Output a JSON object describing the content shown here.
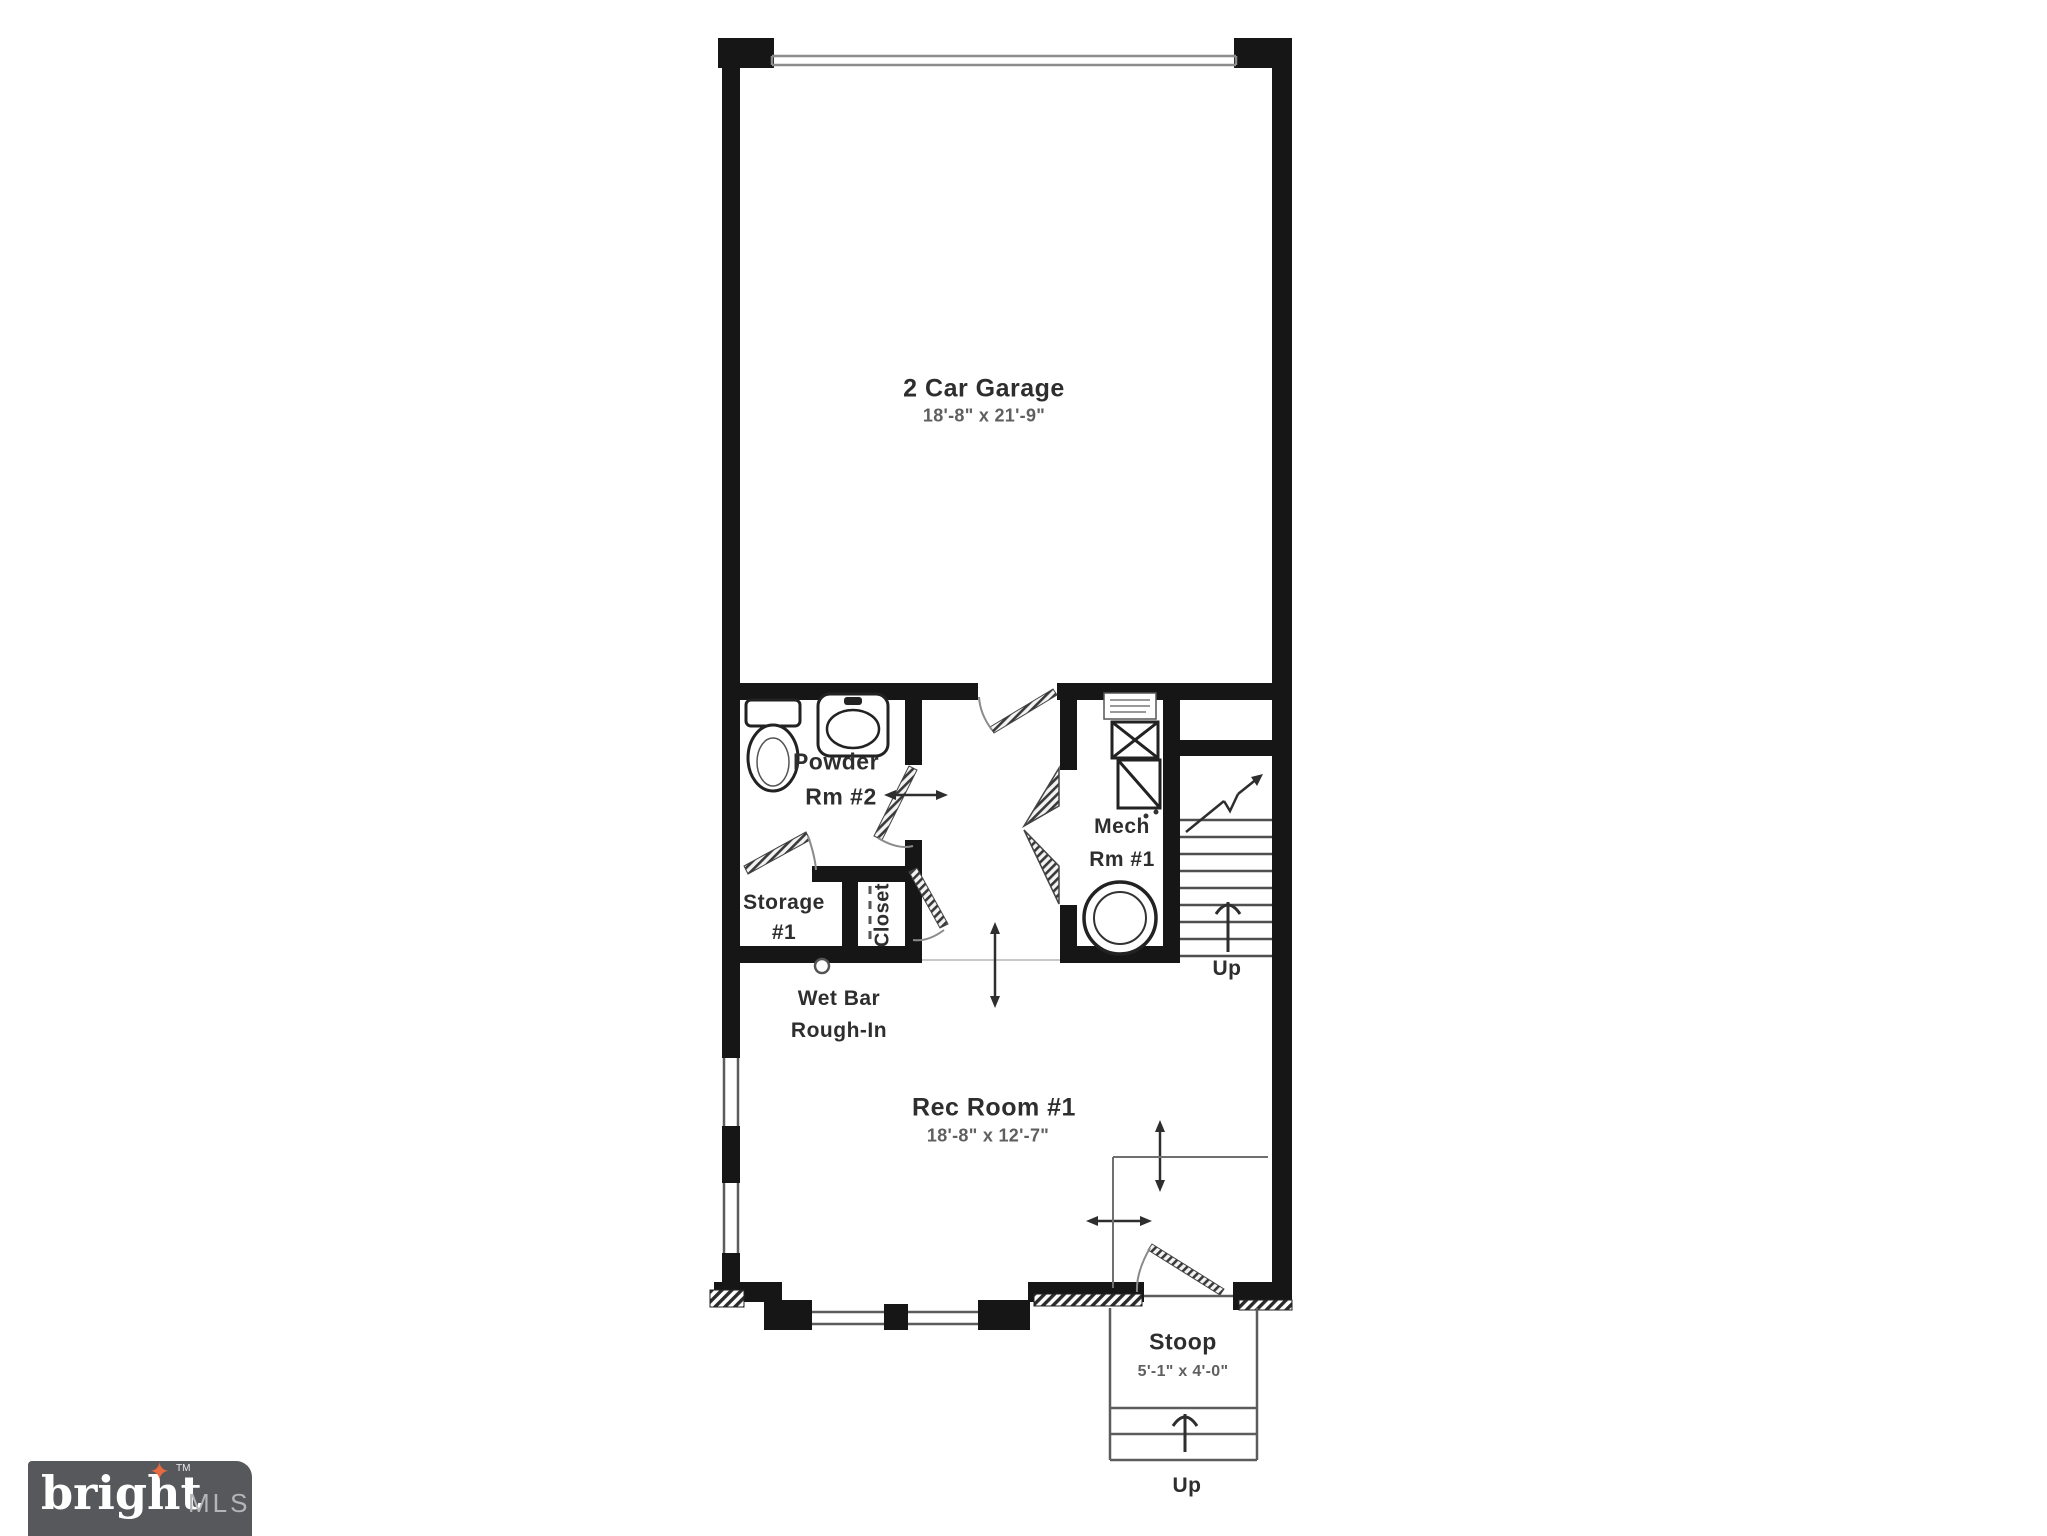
{
  "floor_plan": {
    "garage": {
      "name": "2 Car Garage",
      "dims": "18'-8\" x 21'-9\""
    },
    "powder_room": {
      "line1": "Powder",
      "line2": "Rm #2"
    },
    "storage": {
      "line1": "Storage",
      "line2": "#1"
    },
    "closet": {
      "name": "Closet"
    },
    "mech_room": {
      "line1": "Mech",
      "line2": "Rm #1"
    },
    "stairs": {
      "label": "Up"
    },
    "wet_bar": {
      "line1": "Wet Bar",
      "line2": "Rough-In"
    },
    "rec_room": {
      "name": "Rec Room #1",
      "dims": "18'-8\" x 12'-7\""
    },
    "stoop": {
      "name": "Stoop",
      "dims": "5'-1\" x 4'-0\"",
      "stairs_label": "Up"
    },
    "colors": {
      "wall": "#161616",
      "thin_line": "#6f6f6f",
      "label_text": "#2e2e2e",
      "dim_text": "#5f5f5f"
    }
  },
  "watermark": {
    "brand": "bright",
    "trademark": "TM",
    "suffix": "MLS",
    "star_glyph": "✦",
    "colors": {
      "background": "#56585b",
      "brand": "#ffffff",
      "suffix": "#b3b5b8",
      "star": "#e76a41"
    }
  }
}
